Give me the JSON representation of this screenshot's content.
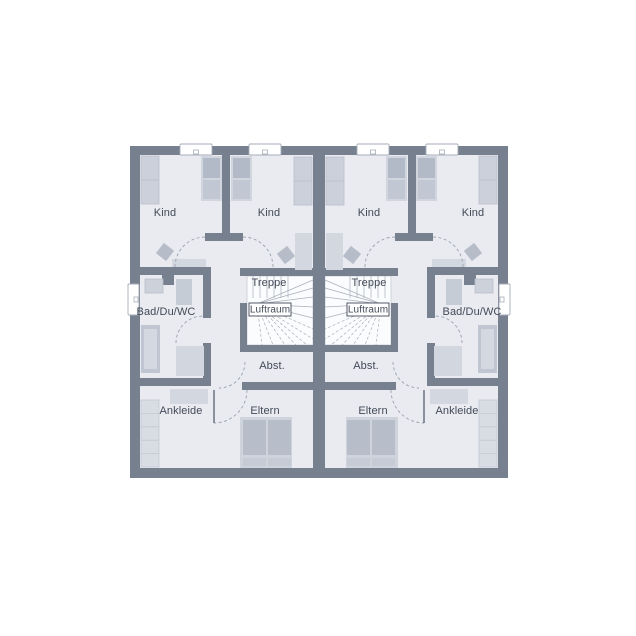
{
  "title": "Obergeschoss Grundriss Doppelhaus",
  "labels": {
    "kind": "Kind",
    "treppe": "Treppe",
    "luftraum": "Luftraum",
    "bad": "Bad/Du/WC",
    "abst": "Abst.",
    "ankleide": "Ankleide",
    "eltern": "Eltern"
  },
  "colors": {
    "page_bg": "#ffffff",
    "wall": "#76808f",
    "floor": "#e9ebf0",
    "stair_bg": "#fbfcfd",
    "stair_line": "#a9afbb",
    "stair_border": "#c6cad2",
    "window_fill": "#ffffff",
    "window_stroke": "#a6adb8",
    "arc": "#9aa1ad",
    "leaf": "#6b7380",
    "label_text": "#434a57",
    "luftraum_border": "#424857",
    "furn_light": "#d3d7e0",
    "furn_mid": "#c2c8d3",
    "furn_dark": "#b3bac7"
  },
  "plan": {
    "x": 130,
    "y": 146,
    "w": 378,
    "h": 332,
    "floor": {
      "x": 10,
      "y": 9,
      "w": 173,
      "h": 313
    },
    "walls": [
      {
        "n": "wall-top",
        "x": 0,
        "y": 0,
        "w": 195,
        "h": 9
      },
      {
        "n": "wall-left",
        "x": 0,
        "y": 0,
        "w": 10,
        "h": 332
      },
      {
        "n": "wall-bottom",
        "x": 0,
        "y": 322,
        "w": 195,
        "h": 10
      },
      {
        "n": "wall-party",
        "x": 183,
        "y": 0,
        "w": 12,
        "h": 332
      },
      {
        "n": "wall-kind-divider",
        "x": 92,
        "y": 9,
        "w": 8,
        "h": 86
      },
      {
        "n": "wall-hall-stub",
        "x": 75,
        "y": 87,
        "w": 38,
        "h": 8
      },
      {
        "n": "wall-kind-bottom",
        "x": 10,
        "y": 121,
        "w": 71,
        "h": 8
      },
      {
        "n": "wall-stair-top",
        "x": 110,
        "y": 122,
        "w": 73,
        "h": 8
      },
      {
        "n": "wall-bath-right-a",
        "x": 73,
        "y": 129,
        "w": 8,
        "h": 43
      },
      {
        "n": "wall-bath-right-b",
        "x": 73,
        "y": 197,
        "w": 8,
        "h": 43
      },
      {
        "n": "wall-bath-nib",
        "x": 32,
        "y": 129,
        "w": 12,
        "h": 10
      },
      {
        "n": "wall-bath-bottom",
        "x": 0,
        "y": 232,
        "w": 81,
        "h": 8
      },
      {
        "n": "wall-stair-left",
        "x": 110,
        "y": 157,
        "w": 7,
        "h": 49
      },
      {
        "n": "wall-stair-bottom",
        "x": 110,
        "y": 199,
        "w": 73,
        "h": 7
      },
      {
        "n": "wall-abst-bottom",
        "x": 112,
        "y": 236,
        "w": 71,
        "h": 8
      }
    ],
    "windows": [
      {
        "n": "window-kind-left",
        "x": 50,
        "y": -2,
        "w": 32,
        "h": 11,
        "tick": "h"
      },
      {
        "n": "window-kind-right",
        "x": 119,
        "y": -2,
        "w": 32,
        "h": 11,
        "tick": "h"
      },
      {
        "n": "window-bath",
        "x": -2,
        "y": 138,
        "w": 11,
        "h": 31,
        "tick": "v"
      }
    ],
    "furniture": [
      {
        "n": "wardrobe-kind-left",
        "x": 11,
        "y": 10,
        "w": 18,
        "h": 48,
        "f": "#cbd0da",
        "s": "#b9bfcb",
        "cells": 2
      },
      {
        "n": "bed-kind-left-frame",
        "x": 71,
        "y": 10,
        "w": 21,
        "h": 45,
        "f": "#d0d5de"
      },
      {
        "n": "bed-kind-left-pillow",
        "x": 73,
        "y": 12,
        "w": 17,
        "h": 20,
        "f": "#b3bac7"
      },
      {
        "n": "bed-kind-left-mattress",
        "x": 73,
        "y": 34,
        "w": 17,
        "h": 19,
        "f": "#c2c8d3"
      },
      {
        "n": "chair-kind-left",
        "x": 28.5,
        "y": 99.5,
        "w": 13,
        "h": 13,
        "f": "#b6bdc9",
        "rot": 38
      },
      {
        "n": "desk-kind-left",
        "x": 42,
        "y": 113,
        "w": 34,
        "h": 8,
        "f": "#d3d7e0"
      },
      {
        "n": "bed-kind-right-frame",
        "x": 101,
        "y": 10,
        "w": 21,
        "h": 45,
        "f": "#d0d5de"
      },
      {
        "n": "bed-kind-right-pillow",
        "x": 103,
        "y": 12,
        "w": 17,
        "h": 20,
        "f": "#b3bac7"
      },
      {
        "n": "bed-kind-right-mattress",
        "x": 103,
        "y": 34,
        "w": 17,
        "h": 19,
        "f": "#c2c8d3"
      },
      {
        "n": "wardrobe-kind-right",
        "x": 164,
        "y": 11,
        "w": 18,
        "h": 48,
        "f": "#cbd0da",
        "s": "#b9bfcb",
        "cells": 2
      },
      {
        "n": "desk-kind-right",
        "x": 165,
        "y": 87,
        "w": 17,
        "h": 37,
        "f": "#d3d7e0"
      },
      {
        "n": "chair-kind-right",
        "x": 149.5,
        "y": 102.5,
        "w": 13,
        "h": 13,
        "f": "#b6bdc9",
        "rot": -38
      },
      {
        "n": "washbasin",
        "x": 15,
        "y": 133,
        "w": 18,
        "h": 14,
        "f": "#ccd1da",
        "s": "#b9bfcb"
      },
      {
        "n": "bath-cabinet",
        "x": 46,
        "y": 133,
        "w": 16,
        "h": 26,
        "f": "#c6ccd6"
      },
      {
        "n": "bathtub",
        "x": 11,
        "y": 179,
        "w": 19,
        "h": 48,
        "f": "#bfc5d1"
      },
      {
        "n": "bathtub-inner",
        "x": 14,
        "y": 183,
        "w": 13,
        "h": 40,
        "f": "#d4d8e0"
      },
      {
        "n": "wc",
        "x": 46,
        "y": 200,
        "w": 28,
        "h": 30,
        "f": "#d2d6df"
      },
      {
        "n": "sideboard-ankleide",
        "x": 40,
        "y": 243,
        "w": 38,
        "h": 15,
        "f": "#d3d7e0"
      },
      {
        "n": "wardrobe-ankleide",
        "x": 11,
        "y": 254,
        "w": 18,
        "h": 67,
        "f": "#d8dce3",
        "s": "#c3c8d2",
        "cells": 5
      },
      {
        "n": "bed-eltern-frame",
        "x": 110,
        "y": 271,
        "w": 52,
        "h": 51,
        "f": "#ced3dc"
      },
      {
        "n": "bed-eltern-mattress-l",
        "x": 113,
        "y": 274,
        "w": 23,
        "h": 35,
        "f": "#b7beca"
      },
      {
        "n": "bed-eltern-mattress-r",
        "x": 138,
        "y": 274,
        "w": 23,
        "h": 35,
        "f": "#b7beca"
      },
      {
        "n": "bed-eltern-pillow-l",
        "x": 113,
        "y": 312,
        "w": 23,
        "h": 8,
        "f": "#c6ccd5"
      },
      {
        "n": "bed-eltern-pillow-r",
        "x": 138,
        "y": 312,
        "w": 23,
        "h": 8,
        "f": "#c6ccd5"
      }
    ],
    "door_arcs": [
      {
        "n": "door-arc-kind-left",
        "d": "M 45 121 A 30 30 0 0 1 75 91"
      },
      {
        "n": "door-arc-kind-right",
        "d": "M 113 91 A 30 30 0 0 1 143 121"
      },
      {
        "n": "door-arc-bath",
        "d": "M 46 197 A 27 27 0 0 1 73 170"
      },
      {
        "n": "door-arc-abst",
        "d": "M 115 216 A 26 26 0 0 1 89 242"
      },
      {
        "n": "door-arc-eltern",
        "d": "M 117 244 A 33 33 0 0 1 84 277"
      }
    ],
    "door_leafs": [
      {
        "n": "door-leaf-eltern",
        "x1": 84,
        "y1": 244,
        "x2": 84,
        "y2": 277
      }
    ],
    "stairs": {
      "area": {
        "x": 117,
        "y": 130,
        "w": 66,
        "h": 69
      },
      "tread_lines": [
        [
          123,
          130,
          123,
          152
        ],
        [
          130,
          130,
          130,
          152
        ],
        [
          137,
          130,
          137,
          152
        ],
        [
          144,
          130,
          144,
          152
        ],
        [
          151,
          130,
          151,
          152
        ],
        [
          158,
          130,
          158,
          152
        ]
      ],
      "fan_pole": [
        127,
        158
      ],
      "fan_targets": [
        [
          183,
          134
        ],
        [
          183,
          142
        ],
        [
          183,
          151
        ],
        [
          183,
          161
        ],
        [
          183,
          172
        ],
        [
          183,
          183
        ],
        [
          183,
          193
        ],
        [
          177,
          199
        ],
        [
          166,
          199
        ],
        [
          155,
          199
        ],
        [
          143,
          199
        ],
        [
          132,
          199
        ]
      ],
      "box": {
        "x": 119,
        "y": 157,
        "w": 42,
        "h": 13
      }
    },
    "room_labels": [
      {
        "key": "kind",
        "cx": 35,
        "cy": 67
      },
      {
        "key": "kind",
        "cx": 139,
        "cy": 67
      },
      {
        "key": "treppe",
        "cx": 139,
        "cy": 137
      },
      {
        "key": "luftraum",
        "cx": 140,
        "cy": 163.5,
        "small": true
      },
      {
        "key": "bad",
        "cx": 36,
        "cy": 166
      },
      {
        "key": "abst",
        "cx": 142,
        "cy": 220
      },
      {
        "key": "ankleide",
        "cx": 51,
        "cy": 265
      },
      {
        "key": "eltern",
        "cx": 135,
        "cy": 265
      }
    ]
  }
}
